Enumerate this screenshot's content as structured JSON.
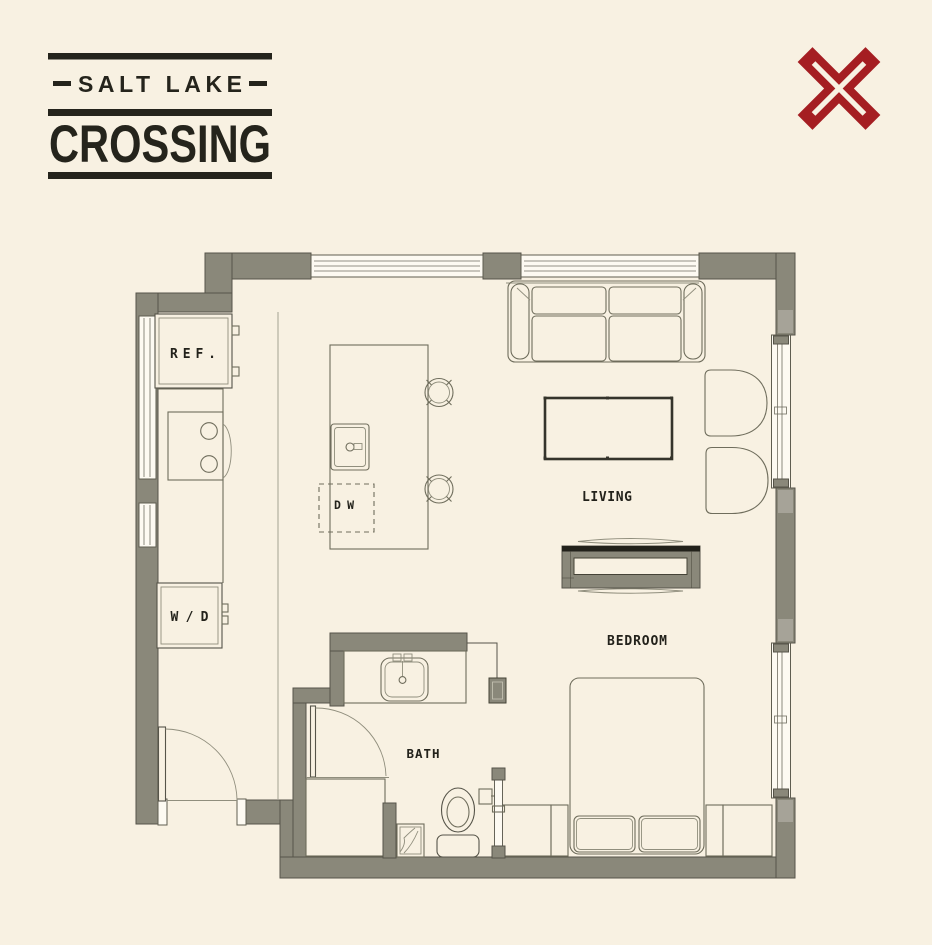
{
  "logo": {
    "line1": "SALT LAKE",
    "line2": "CROSSING"
  },
  "plan": {
    "labels": {
      "living": "LIVING",
      "bedroom": "BEDROOM",
      "bath": "BATH",
      "refrigerator": "REF.",
      "dishwasher": "DW",
      "washer_dryer": "W/D"
    }
  },
  "colors": {
    "background": "#f8f1e2",
    "wall": "#8a887a",
    "ink": "#25241c",
    "furniture_line": "#6f6d5c",
    "logo_red": "#a51e22",
    "window": "#fdfaf2"
  }
}
